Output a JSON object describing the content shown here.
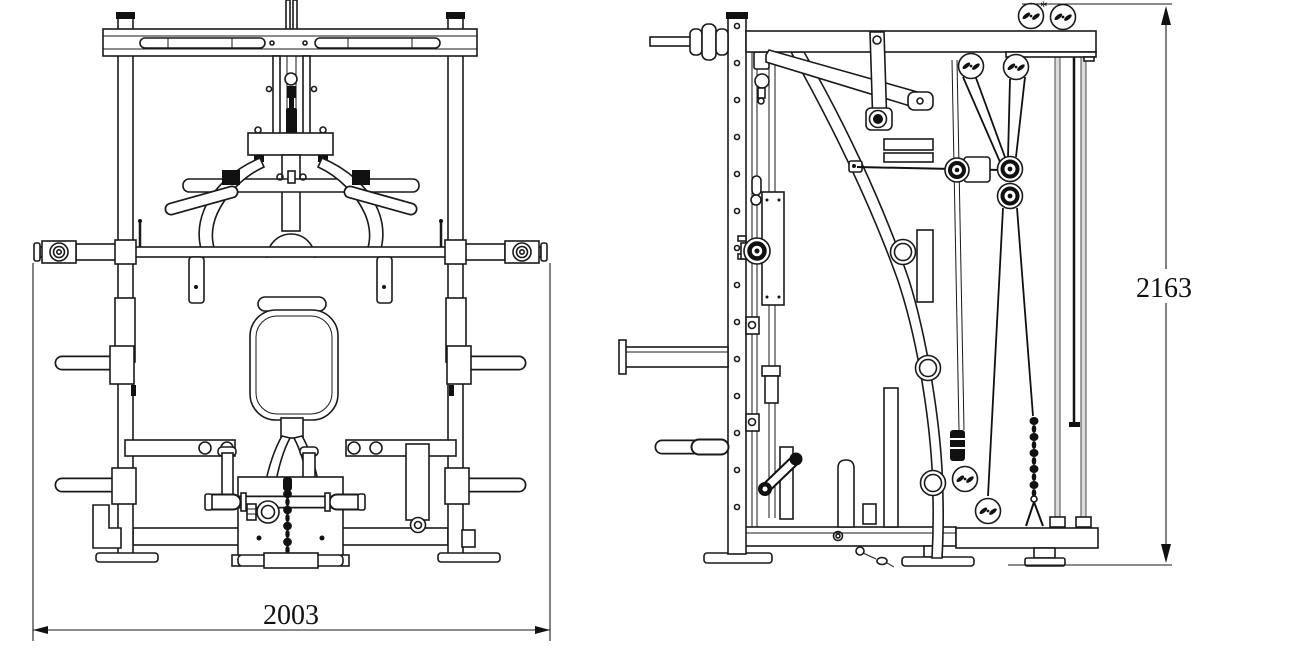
{
  "drawing": {
    "colors": {
      "background": "#ffffff",
      "ink": "#1a1a1a",
      "rod_shade": "#dcdcdc"
    },
    "dimensions": {
      "width": {
        "value": "2003"
      },
      "height": {
        "value": "2163"
      },
      "top_marker": "*"
    }
  }
}
